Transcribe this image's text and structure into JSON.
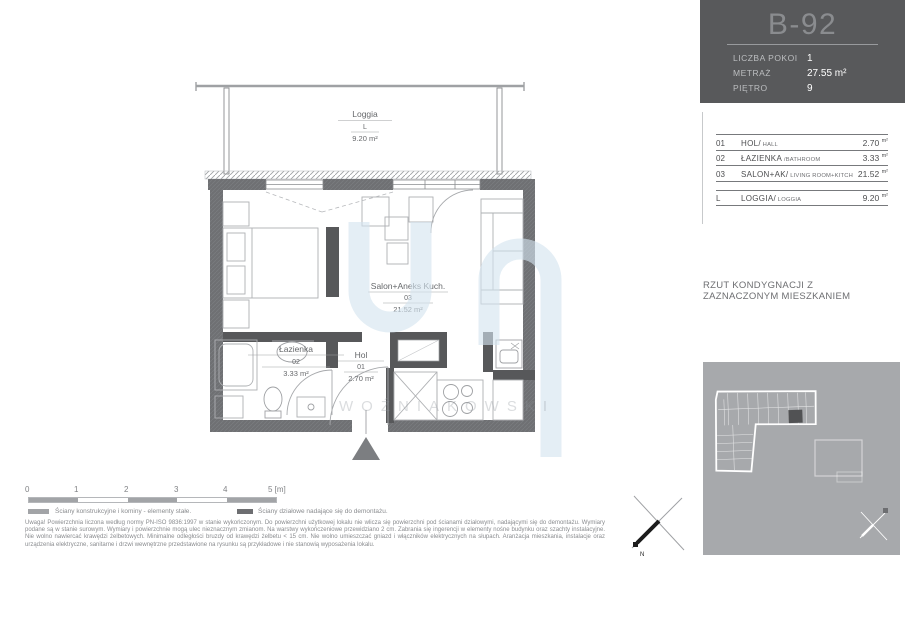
{
  "unit_card": {
    "title": "B-92",
    "rows": [
      {
        "label": "LICZBA POKOI",
        "value": "1"
      },
      {
        "label": "METRAŻ",
        "value": "27.55 m²"
      },
      {
        "label": "PIĘTRO",
        "value": "9"
      }
    ]
  },
  "room_table": {
    "rows": [
      {
        "no": "01",
        "name": "HOL/",
        "alt": " HALL",
        "area": "2.70",
        "unit": "m²"
      },
      {
        "no": "02",
        "name": "ŁAZIENKA",
        "alt": " /BATHROOM",
        "area": "3.33",
        "unit": "m²"
      },
      {
        "no": "03",
        "name": "SALON+AK/",
        "alt": " LIVING ROOM+KITCH",
        "area": "21.52",
        "unit": "m²"
      }
    ],
    "loggia": {
      "no": "L",
      "name": "LOGGIA/",
      "alt": " LOGGIA",
      "area": "9.20",
      "unit": "m²"
    }
  },
  "caption": {
    "line1": "RZUT KONDYGNACJI Z",
    "line2": "ZAZNACZONYM MIESZKANIEM"
  },
  "plan_labels": {
    "loggia": {
      "name": "Loggia",
      "number": "L",
      "area": "9.20 m²"
    },
    "salon": {
      "name": "Salon+Aneks Kuch.",
      "number": "03",
      "area": "21.52 m²"
    },
    "lazienka": {
      "name": "Łazienka",
      "number": "02",
      "area": "3.33 m²"
    },
    "hol": {
      "name": "Hol",
      "number": "01",
      "area": "2.70 m²"
    }
  },
  "scale": {
    "ticks": [
      "0",
      "1",
      "2",
      "3",
      "4",
      "5 [m]"
    ]
  },
  "legend": {
    "structural": "Ściany konstrukcyjne i kominy - elementy stałe.",
    "partition": "Ściany działowe nadające się do demontażu."
  },
  "disclaimer": "Uwaga! Powierzchnia liczona według normy PN-ISO 9836:1997 w stanie wykończonym. Do powierzchni użytkowej lokalu nie wlicza się powierzchni pod ścianami działowymi, nadającymi się do demontażu. Wymiary podane są w stanie surowym. Wymiary i powierzchnie mogą ulec nieznacznym zmianom. Na warstwy wykończeniowe przewidziano 2 cm. Zabrania się ingerencji w elementy nośne budynku oraz szachty instalacyjne. Nie wolno nawiercać krawędzi żelbetowych. Minimalne odległości bruzdy od krawędzi żelbetu < 15 cm. Nie wolno umieszczać gniazd i włączników elektrycznych na słupach. Aranżacja mieszkania, instalacje oraz urządzenia elektryczne, sanitarne i drzwi wewnętrzne przedstawione na rysunku są przykładowe i nie stanowią wyposażenia lokalu.",
  "watermark": {
    "text": "WOŹNIAKOWSKI"
  },
  "compass": {
    "north_label": "N"
  },
  "colors": {
    "card_bg": "#58595b",
    "outer_wall": "#6f7073",
    "partition_wall": "#57585a",
    "minimap_bg": "#a7a9ac",
    "watermark_blue": "#d3e3ef"
  }
}
